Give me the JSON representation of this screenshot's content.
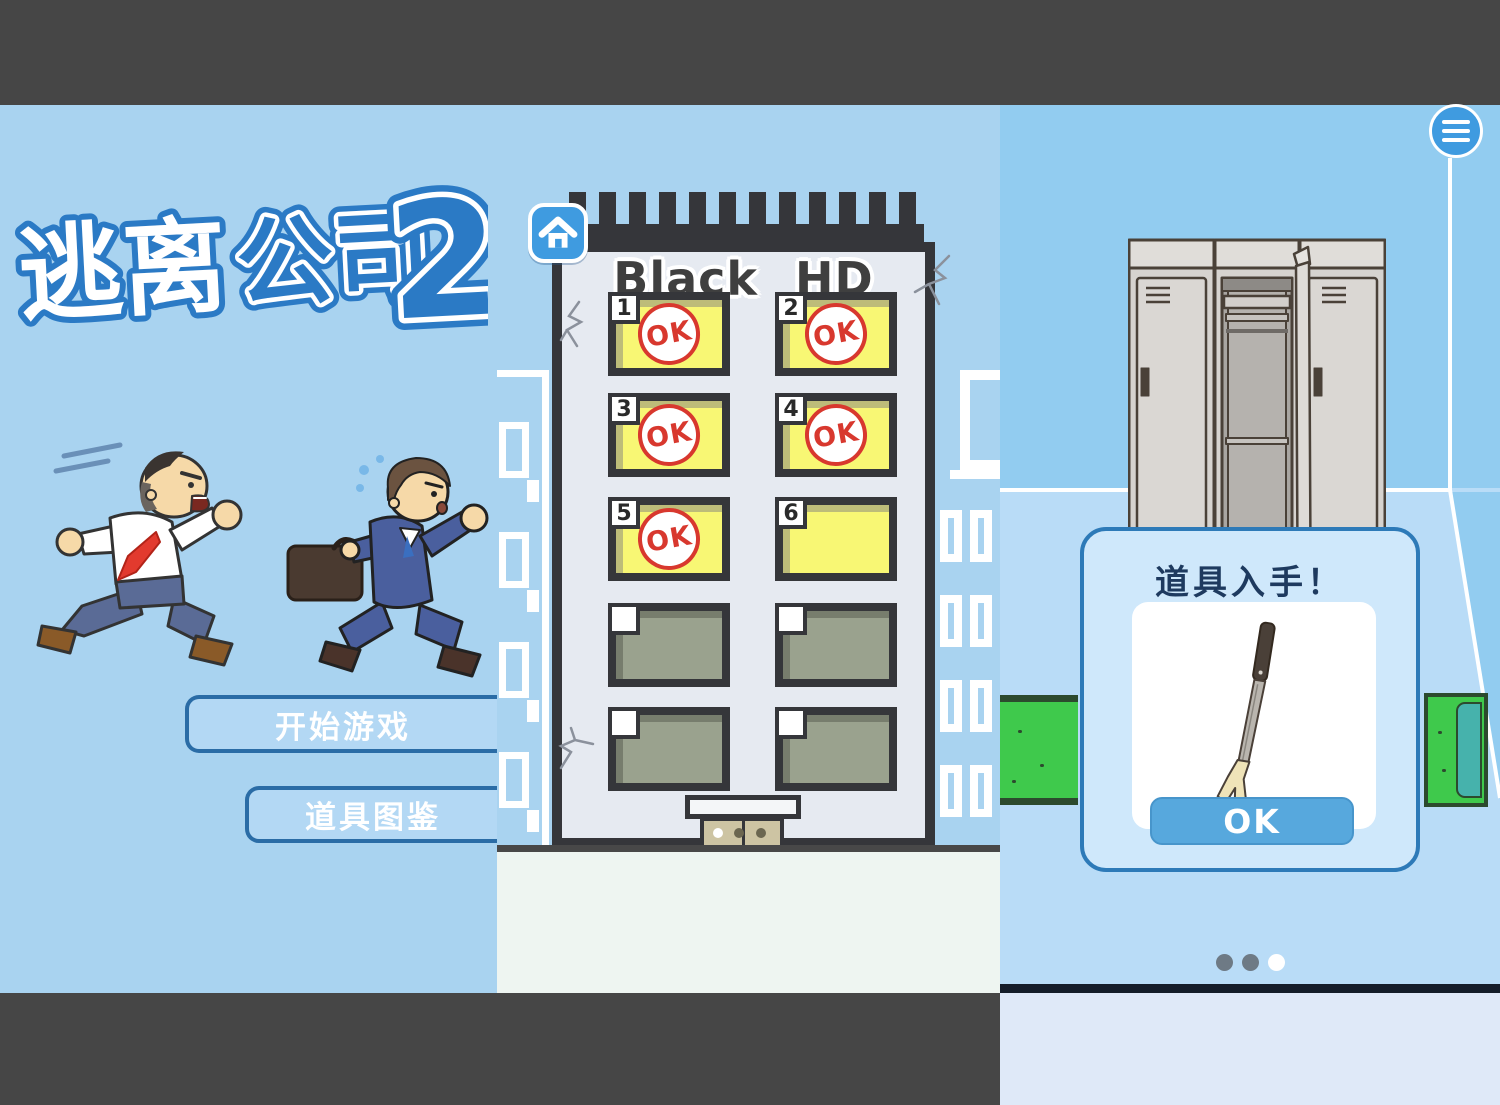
{
  "app": {
    "name": "逃离公司2"
  },
  "title_screen": {
    "logo_text": "逃离公司2",
    "logo_part_a": "逃离",
    "logo_part_b": "公司",
    "logo_part_c": "2",
    "start_button": "开始游戏",
    "items_button": "道具图鉴"
  },
  "level_select": {
    "building_name": "Black HD",
    "levels": [
      {
        "num": "1",
        "stamp": "OK"
      },
      {
        "num": "2",
        "stamp": "OK"
      },
      {
        "num": "3",
        "stamp": "OK"
      },
      {
        "num": "4",
        "stamp": "OK"
      },
      {
        "num": "5",
        "stamp": "OK"
      },
      {
        "num": "6",
        "stamp": ""
      },
      {
        "num": "",
        "stamp": ""
      },
      {
        "num": "",
        "stamp": ""
      },
      {
        "num": "",
        "stamp": ""
      },
      {
        "num": "",
        "stamp": ""
      }
    ]
  },
  "item_popup": {
    "title": "道具入手！",
    "ok_button": "OK"
  },
  "pagination": {
    "total": 3,
    "active_dot": 3
  },
  "icons": {
    "home": "home-icon",
    "menu": "hamburger-menu-icon",
    "item": "shoehorn-stick-icon"
  },
  "colors": {
    "letterbox_dark": "#464646",
    "sky_blue": "#a9d3f0",
    "room_wall_blue": "#92ccf0",
    "room_wall_light": "#b9dcf7",
    "logo_blue": "#2b7ac5",
    "button_border_blue": "#2a6ca6",
    "ui_blue": "#3f9be0",
    "window_yellow": "#f8f774",
    "stamp_red": "#d8382e",
    "bench_green": "#3fc94c",
    "popup_border": "#2d7ab8"
  }
}
